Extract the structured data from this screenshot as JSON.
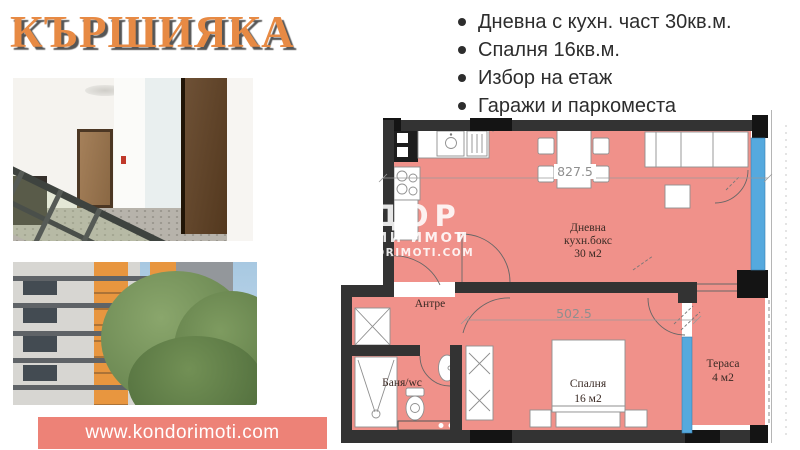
{
  "title": "КЪРШИЯКА",
  "features": {
    "items": [
      "Дневна с кухн. част 30кв.м.",
      "Спалня 16кв.м.",
      "Избор на етаж",
      "Гаражи и паркоместа"
    ]
  },
  "banner": {
    "url": "www.kondorimoti.com"
  },
  "plan": {
    "dims": {
      "width": "827.5",
      "depth": "502.5"
    },
    "rooms": {
      "living": {
        "l1": "Дневна",
        "l2": "кухн.бокс",
        "l3": "30 м2"
      },
      "hall": {
        "name": "Антре"
      },
      "bath": {
        "name": "Баня/wc"
      },
      "bedroom": {
        "l1": "Спалня",
        "l2": "16 м2"
      },
      "terrace": {
        "l1": "Тераса",
        "l2": "4 м2"
      }
    },
    "watermark": {
      "big": "ДОР",
      "mid_a": "ИМИ ИМОТ",
      "mid_b": "И",
      "small": "DORIMOTI.COM"
    }
  },
  "colors": {
    "title_orange": "#e78a44",
    "banner_salmon": "#ed8277",
    "room_fill": "#f0918a",
    "wall": "#333333",
    "window_blue": "#55a9de"
  }
}
